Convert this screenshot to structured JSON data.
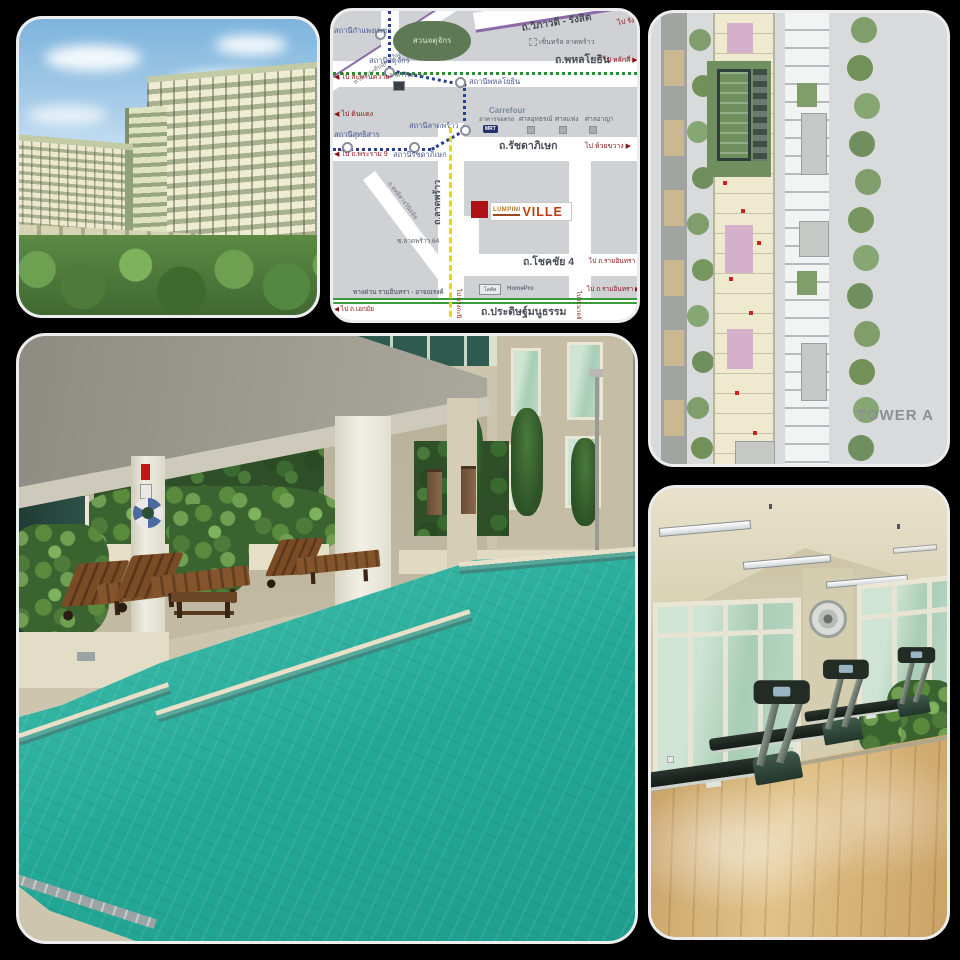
{
  "map": {
    "park_label": "สวนจตุจักร",
    "road_vibhavadi": "ถ.วิภาวดี - รังสิต",
    "dir_rangsit": "ไป รังสิต ▶",
    "road_phahonyothin": "ถ.พหลโยธิน",
    "dir_laksi": "ไป หลักสี่ ▶",
    "dir_saphan_khwai": "◀ ไป สะพานควาย",
    "dir_din_daeng": "◀ ไป ดินแดง",
    "st_kamphaeng_phet": "สถานีกำแพงเพชร",
    "st_chatuchak": "สถานีจตุจักร",
    "st_phahonyothin": "สถานีพหลโยธิน",
    "st_lat_phrao": "สถานีลาดพร้าว",
    "st_ratchadaphisek": "สถานีรัชดาภิเษก",
    "st_sutthisan": "สถานีสุทธิสาร",
    "dir_rama9": "◀ ไป ถ.พระราม 9",
    "tollway": "ทางยกระดับอุตราภิมุข",
    "parking_garage": "อาคารจอดรถ",
    "mrt_badge": "MRT",
    "central_ladprao": "เซ็นทรัล ลาดพร้าว",
    "carrefour": "Carrefour",
    "courts": [
      "ศาลอุทธรณ์",
      "ศาลแพ่ง",
      "ศาลอาญา"
    ],
    "road_ratchadaphisek": "ถ.รัชดาภิเษก",
    "dir_huai_khwang": "ไป ห้วยขวาง ▶",
    "road_lat_phrao": "ถ.ลาดพร้าว",
    "road_sutthisan": "ถ.สุทธิสารวินิจฉัย",
    "soi_lat_phrao_64": "ซ.ลาดพร้าว 64",
    "logo_lumpini": "LUMPINI",
    "logo_ville": "VILLE",
    "road_chok_chai_4": "ถ.โชคชัย 4",
    "dir_ram_inthra_1": "ไป ถ.รามอินทรา ▶",
    "lotus": "โลตัส",
    "homepro": "HomePro",
    "expressway": "ทางด่วน รามอินทรา - อาจณรงค์",
    "dir_ekkamai": "◀ ไป ถ.เอกมัย",
    "road_pradit_manutham": "ถ.ประดิษฐ์มนูธรรม",
    "dir_ram_inthra_2": "ไป ถ.รามอินทรา ▶",
    "dir_bang_kapi": "ไป บางกะปิ",
    "dir_nuan_chan": "ไป ถ.นวลจันทร์"
  },
  "floor_plan": {
    "tower_label": "TOWER A"
  },
  "colors": {
    "collage_background": "#000000",
    "logo_red": "#b01116",
    "logo_ville_text": "#c23a0e",
    "map_block_gray": "#cfd1d4",
    "map_park_green": "#5d7a55",
    "mrt_line_blue": "#2a3f8f",
    "bts_line_green": "#2d8a2d",
    "yellow_line": "#e8d800",
    "expressway_green": "#3a9a3a",
    "tollway_purple": "#8a6aa8",
    "pool_water_teal": "#2fae9e",
    "gym_floor_wood": "#d8b87c"
  }
}
